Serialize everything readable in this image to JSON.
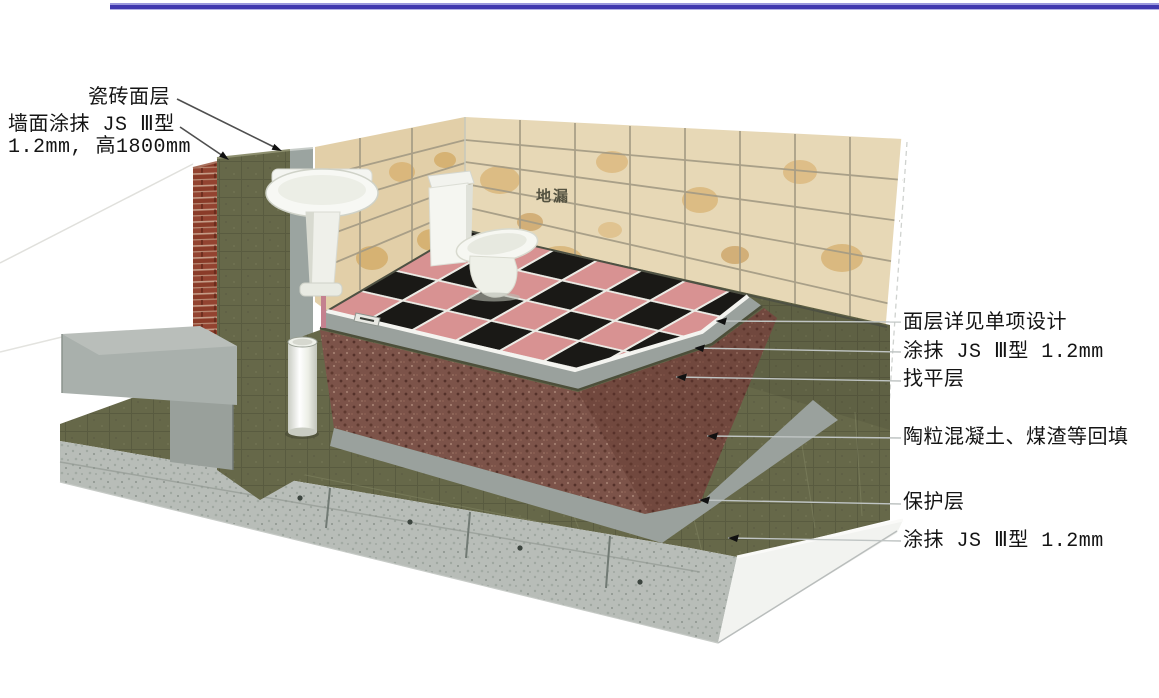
{
  "figure": {
    "description_role": "bathroom-waterproofing-construction-detail",
    "callouts_left": [
      {
        "id": "tile-surface-layer",
        "text": "瓷砖面层"
      },
      {
        "id": "wall-coating-line1",
        "text": "墙面涂抹 JS Ⅲ型"
      },
      {
        "id": "wall-coating-line2",
        "text": "1.2mm, 高1800mm"
      }
    ],
    "callouts_right": [
      {
        "id": "surface-layer-note",
        "text": "面层详见单项设计"
      },
      {
        "id": "coating-js3-upper",
        "text": "涂抹 JS Ⅲ型 1.2mm"
      },
      {
        "id": "leveling-layer",
        "text": "找平层"
      },
      {
        "id": "backfill-layer",
        "text": "陶粒混凝土、煤渣等回填"
      },
      {
        "id": "protection-layer",
        "text": "保护层"
      },
      {
        "id": "coating-js3-lower",
        "text": "涂抹 JS Ⅲ型 1.2mm"
      }
    ],
    "on_model_labels": [
      {
        "id": "floor-drain",
        "text": "地漏"
      }
    ],
    "colors": {
      "top_rule_blue": "#4038ae",
      "wall_tile_beige": "#e7d8b6",
      "wall_tile_blotch": "#cf9c48",
      "membrane_olive": "#666849",
      "brick_red": "#8a3b28",
      "floor_tile_pink": "#d89292",
      "floor_tile_black": "#1a1916",
      "backfill_brown": "#7c5349",
      "concrete_grey": "#b8bdb8",
      "screed_grey": "#9aa19d",
      "leader_grey": "#bfc4c3"
    }
  }
}
